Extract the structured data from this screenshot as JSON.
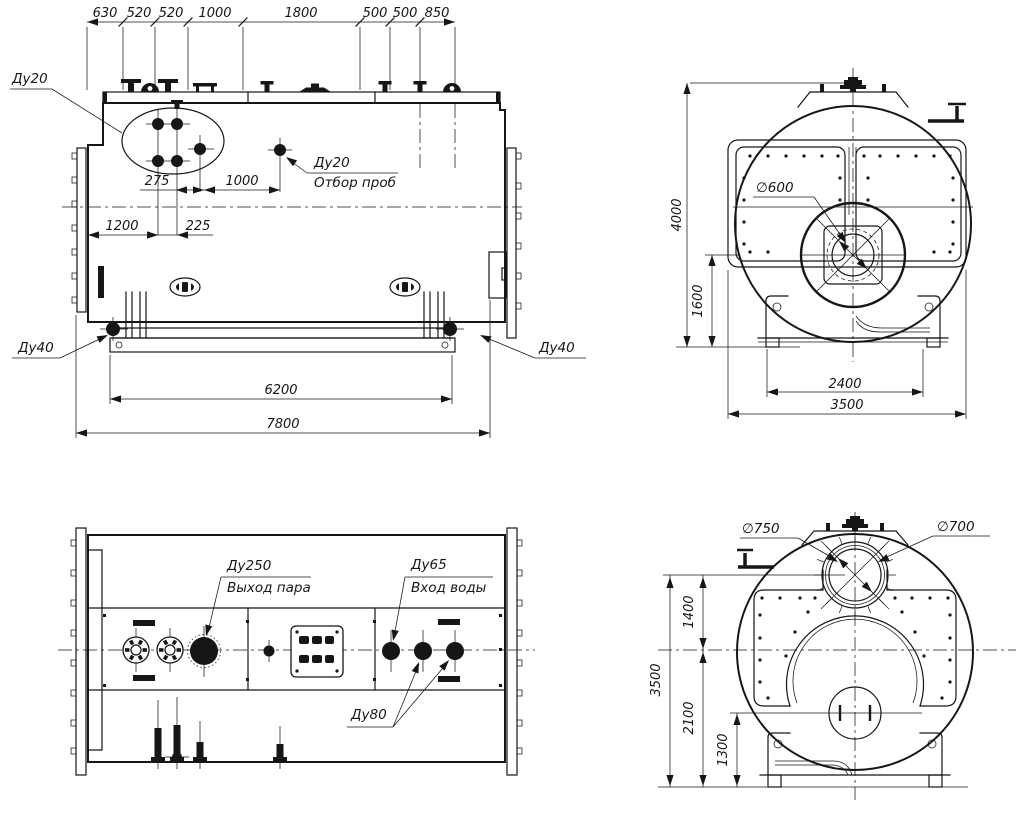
{
  "colors": {
    "background": "#ffffff",
    "ink": "#161616"
  },
  "side_view": {
    "chain_dims": [
      "630",
      "520",
      "520",
      "1000",
      "1800",
      "500",
      "500",
      "850"
    ],
    "dim_275": "275",
    "dim_1000": "1000",
    "dim_1200": "1200",
    "dim_225": "225",
    "dim_6200": "6200",
    "dim_7800": "7800",
    "nozzle_group_label": "Ду20",
    "sample_label_size": "Ду20",
    "sample_label_text": "Отбор проб",
    "drain_left": "Ду40",
    "drain_right": "Ду40"
  },
  "front_view": {
    "dim_height": "4000",
    "dim_1600": "1600",
    "dim_2400": "2400",
    "dim_3500": "3500",
    "burner_dia": "∅600"
  },
  "plan_view": {
    "steam_size": "Ду250",
    "steam_text": "Выход пара",
    "water_size": "Ду65",
    "water_text": "Вход воды",
    "du80": "Ду80"
  },
  "rear_view": {
    "manhole_outer_dia": "∅750",
    "manhole_inner_dia": "∅700",
    "dim_1400": "1400",
    "dim_3500": "3500",
    "dim_2100": "2100",
    "dim_1300": "1300"
  }
}
